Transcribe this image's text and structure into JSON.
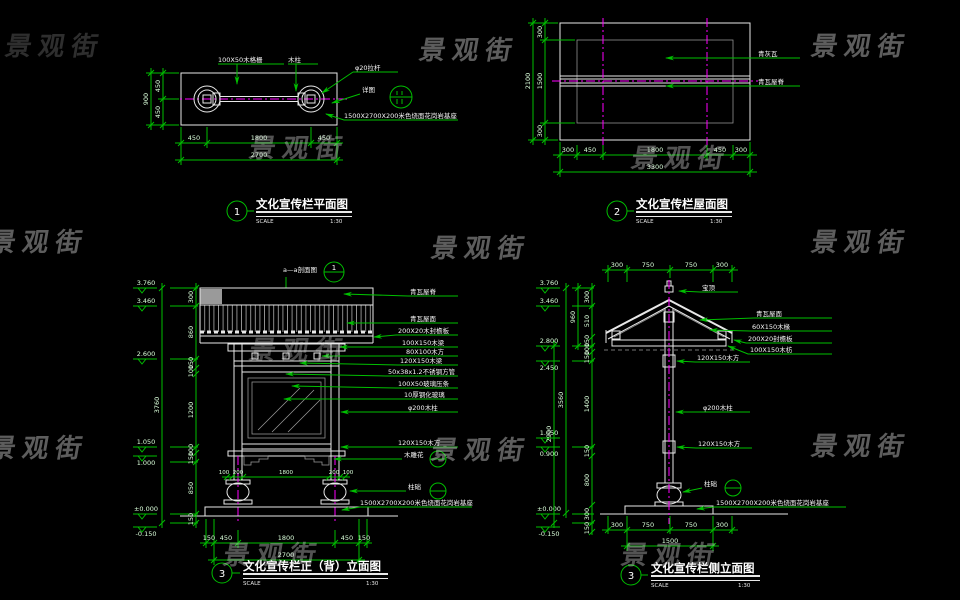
{
  "watermark": {
    "text": "景观街"
  },
  "colors": {
    "background": "#000000",
    "dimension": "#00bf00",
    "linework": "#e8e8e8",
    "centerline": "#ff00ff",
    "label": "#f5f5f5",
    "watermark": "#cfcfcf"
  },
  "view1": {
    "number": "1",
    "title": "文化宣传栏平面图",
    "scale_label": "SCALE",
    "scale": "1:30",
    "labels": {
      "l1": "100X50木格栅",
      "l2": "木柱",
      "l3": "φ20拉杆",
      "l4": "详图",
      "l5": "1500X2700X200米色烧面花岗岩基座"
    },
    "dims": {
      "left": [
        "450",
        "450"
      ],
      "left_total": "900",
      "bottom": [
        "450",
        "1800",
        "450"
      ],
      "bottom_total": "2700"
    }
  },
  "view2": {
    "number": "2",
    "title": "文化宣传栏屋面图",
    "scale_label": "SCALE",
    "scale": "1:30",
    "labels": {
      "l1": "青灰瓦",
      "l2": "青瓦屋脊"
    },
    "dims": {
      "left": [
        "300",
        "1500",
        "300"
      ],
      "left_total": "2100",
      "bottom": [
        "300",
        "450",
        "1800",
        "450",
        "300"
      ],
      "bottom_total": "3300"
    }
  },
  "view3": {
    "number": "3",
    "title": "文化宣传栏正（背）立面图",
    "scale_label": "SCALE",
    "scale": "1:30",
    "section_label": "a—a剖面图",
    "section_bubble": "1",
    "levels": [
      "3.760",
      "3.460",
      "2.600",
      "1.050",
      "1.000",
      "±0.000",
      "-0.150"
    ],
    "dims": {
      "left": [
        "300",
        "860",
        "150",
        "100",
        "1200",
        "100",
        "150",
        "850",
        "150"
      ],
      "left_total": "3760",
      "bottom_mid": [
        "100",
        "200",
        "1800",
        "200",
        "100"
      ],
      "bottom": [
        "150",
        "450",
        "1800",
        "450",
        "150"
      ],
      "bottom_total": "2700"
    },
    "labels": {
      "l1": "青瓦屋脊",
      "l2": "青瓦屋面",
      "l3": "200X20木封檐板",
      "l4": "100X150木梁",
      "l5": "80X100木方",
      "l6": "120X150木梁",
      "l7": "50x38x1.2不锈钢方管",
      "l8": "100X50玻璃压条",
      "l9": "10厚钢化玻璃",
      "l10": "φ200木柱",
      "l11": "120X150木方",
      "l12": "木雕花",
      "l13": "柱础",
      "l14": "1500X2700X200米色烧面花岗岩基座"
    }
  },
  "view4": {
    "number": "3",
    "title": "文化宣传栏侧立面图",
    "scale_label": "SCALE",
    "scale": "1:30",
    "levels": [
      "3.760",
      "3.460",
      "2.800",
      "2.450",
      "1.050",
      "0.900",
      "±0.000",
      "-0.150"
    ],
    "dims": {
      "top": [
        "300",
        "750",
        "750",
        "300"
      ],
      "left": [
        "300",
        "510",
        "150",
        "100",
        "150",
        "1400",
        "150",
        "800",
        "300",
        "150"
      ],
      "left_totals": [
        "960",
        "3560",
        "2900"
      ],
      "bottom": [
        "300",
        "750",
        "750",
        "300"
      ],
      "bottom_total": "1500"
    },
    "labels": {
      "l1": "宝顶",
      "l2": "青瓦屋面",
      "l3": "60X150木椽",
      "l4": "200X20封檐板",
      "l5": "100X150木枋",
      "l6": "120X150木方",
      "l7": "φ200木柱",
      "l8": "120X150木方",
      "l9": "柱础",
      "l10": "1500X2700X200米色烧面花岗岩基座"
    }
  }
}
